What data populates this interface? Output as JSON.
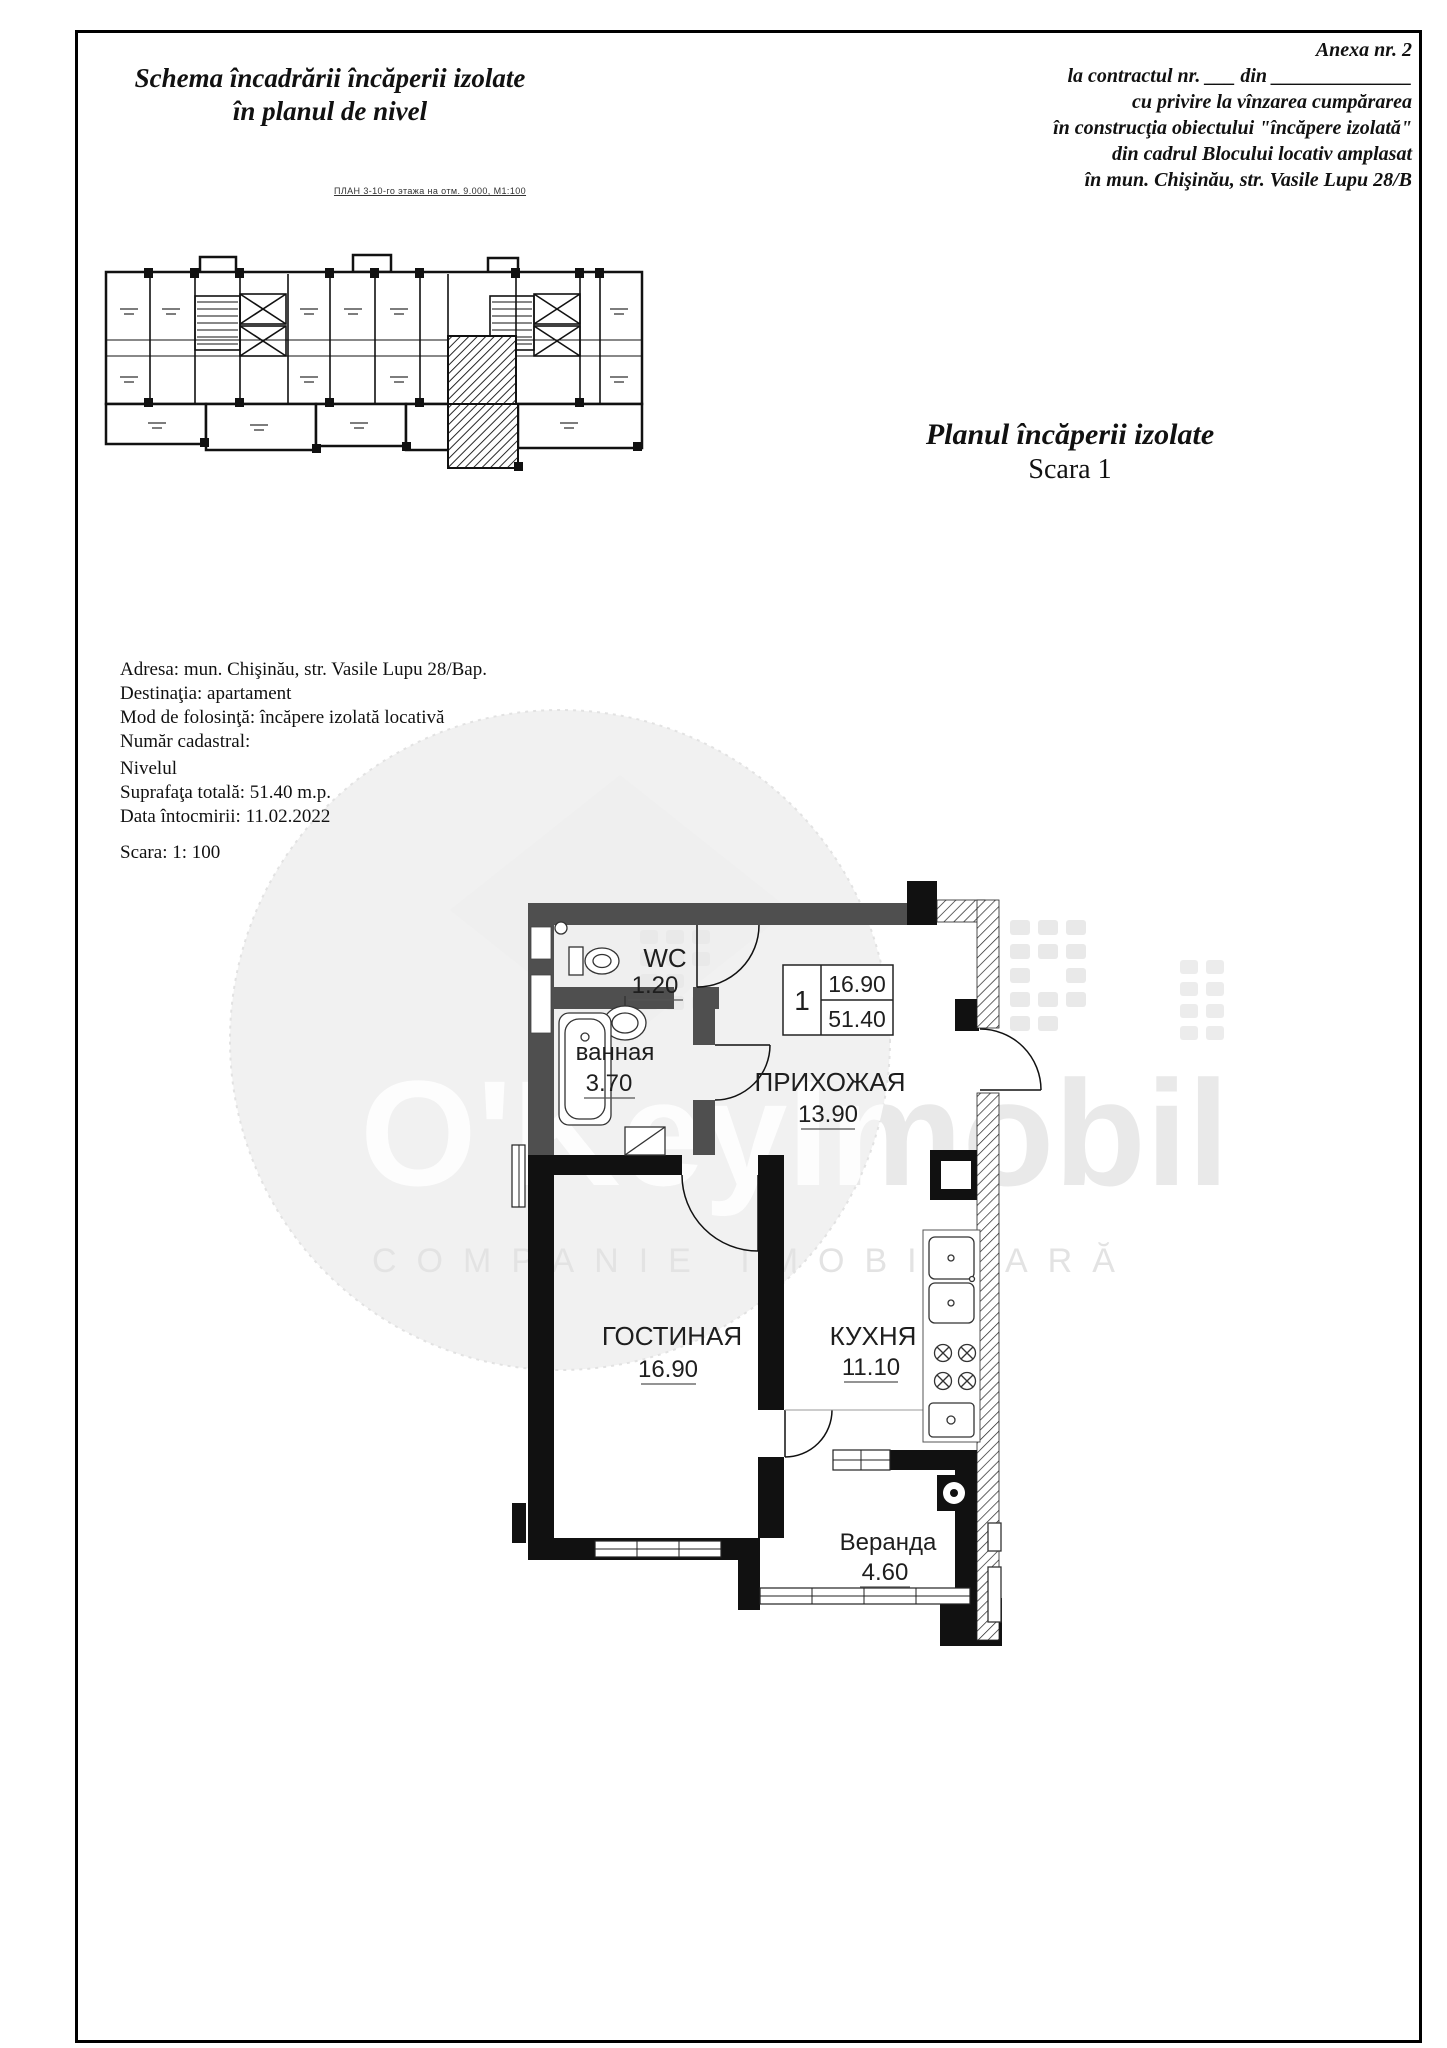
{
  "page": {
    "level_plan_title_1": "Schema încadrării încăperii izolate",
    "level_plan_title_2": "în planul de nivel",
    "level_plan_caption": "ПЛАН 3-10-го этажа на отм. 9.000, М1:100",
    "unit_plan_title": "Planul încăperii izolate",
    "unit_plan_scale": "Scara 1"
  },
  "annex": {
    "lines": [
      "Anexa nr. 2",
      "la contractul nr. ___ din ______________",
      "cu privire la vînzarea cumpărarea",
      "în construcţia obiectului \"încăpere izolată\"",
      "din cadrul Blocului locativ amplasat",
      "în mun. Chişinău, str. Vasile Lupu 28/B"
    ]
  },
  "details": {
    "lines": [
      "Adresa: mun. Chişinău, str. Vasile Lupu 28/Bap.",
      "Destinaţia: apartament",
      "Mod de folosinţă: încăpere izolată locativă",
      "Număr cadastral:",
      "Nivelul",
      "Suprafaţa totală: 51.40 m.p.",
      "Data întocmirii: 11.02.2022",
      "Scara: 1: 100"
    ]
  },
  "rooms": [
    {
      "name": "WC",
      "area": "1.20"
    },
    {
      "name": "ванная",
      "area": "3.70"
    },
    {
      "name": "ПРИХОЖАЯ",
      "area": "13.90"
    },
    {
      "name": "ГОСТИНАЯ",
      "area": "16.90"
    },
    {
      "name": "КУХНЯ",
      "area": "11.10"
    },
    {
      "name": "Веранда",
      "area": "4.60"
    }
  ],
  "area_table": {
    "unit_number": "1",
    "living_area": "16.90",
    "total_area": "51.40"
  },
  "watermark": {
    "brand": "O'KeyImobil",
    "tagline": "COMPANIE IMOBILIARĂ"
  },
  "colors": {
    "wall_gray": "#4f4f4f",
    "wall_black": "#111111",
    "watermark_gray": "#e9e9e9",
    "text": "#1a1a1a"
  }
}
